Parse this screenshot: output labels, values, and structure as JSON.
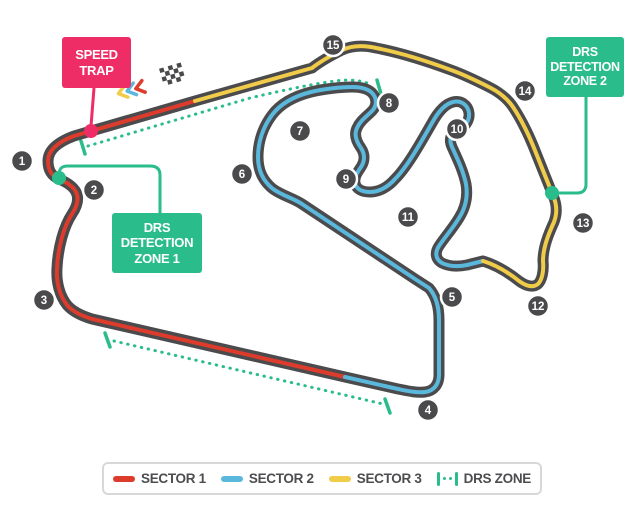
{
  "map": {
    "speed_trap_label": "SPEED TRAP",
    "drs_detection_zone_1_label": "DRS DETECTION ZONE 1",
    "drs_detection_zone_2_label": "DRS DETECTION ZONE 2"
  },
  "legend": {
    "items": [
      {
        "label": "SECTOR 1",
        "color": "#dd3b2b"
      },
      {
        "label": "SECTOR 2",
        "color": "#5bb8dd"
      },
      {
        "label": "SECTOR 3",
        "color": "#f0cc49"
      },
      {
        "label": "DRS ZONE",
        "color": "#2bbc8c"
      }
    ]
  },
  "track": {
    "corners": [
      {
        "number": "1"
      },
      {
        "number": "2"
      },
      {
        "number": "3"
      },
      {
        "number": "4"
      },
      {
        "number": "5"
      },
      {
        "number": "6"
      },
      {
        "number": "7"
      },
      {
        "number": "8"
      },
      {
        "number": "9"
      },
      {
        "number": "10"
      },
      {
        "number": "11"
      },
      {
        "number": "12"
      },
      {
        "number": "13"
      },
      {
        "number": "14"
      },
      {
        "number": "15"
      }
    ],
    "colors": {
      "track_base": "#4b4b4e",
      "sector1": "#dd3b2b",
      "sector2": "#5bb8dd",
      "sector3": "#f0cc49",
      "drs": "#2bbc8c",
      "speed_trap": "#ee2d66",
      "corner_marker": "#4a4a4d",
      "flag": "#4a4a4d"
    }
  }
}
